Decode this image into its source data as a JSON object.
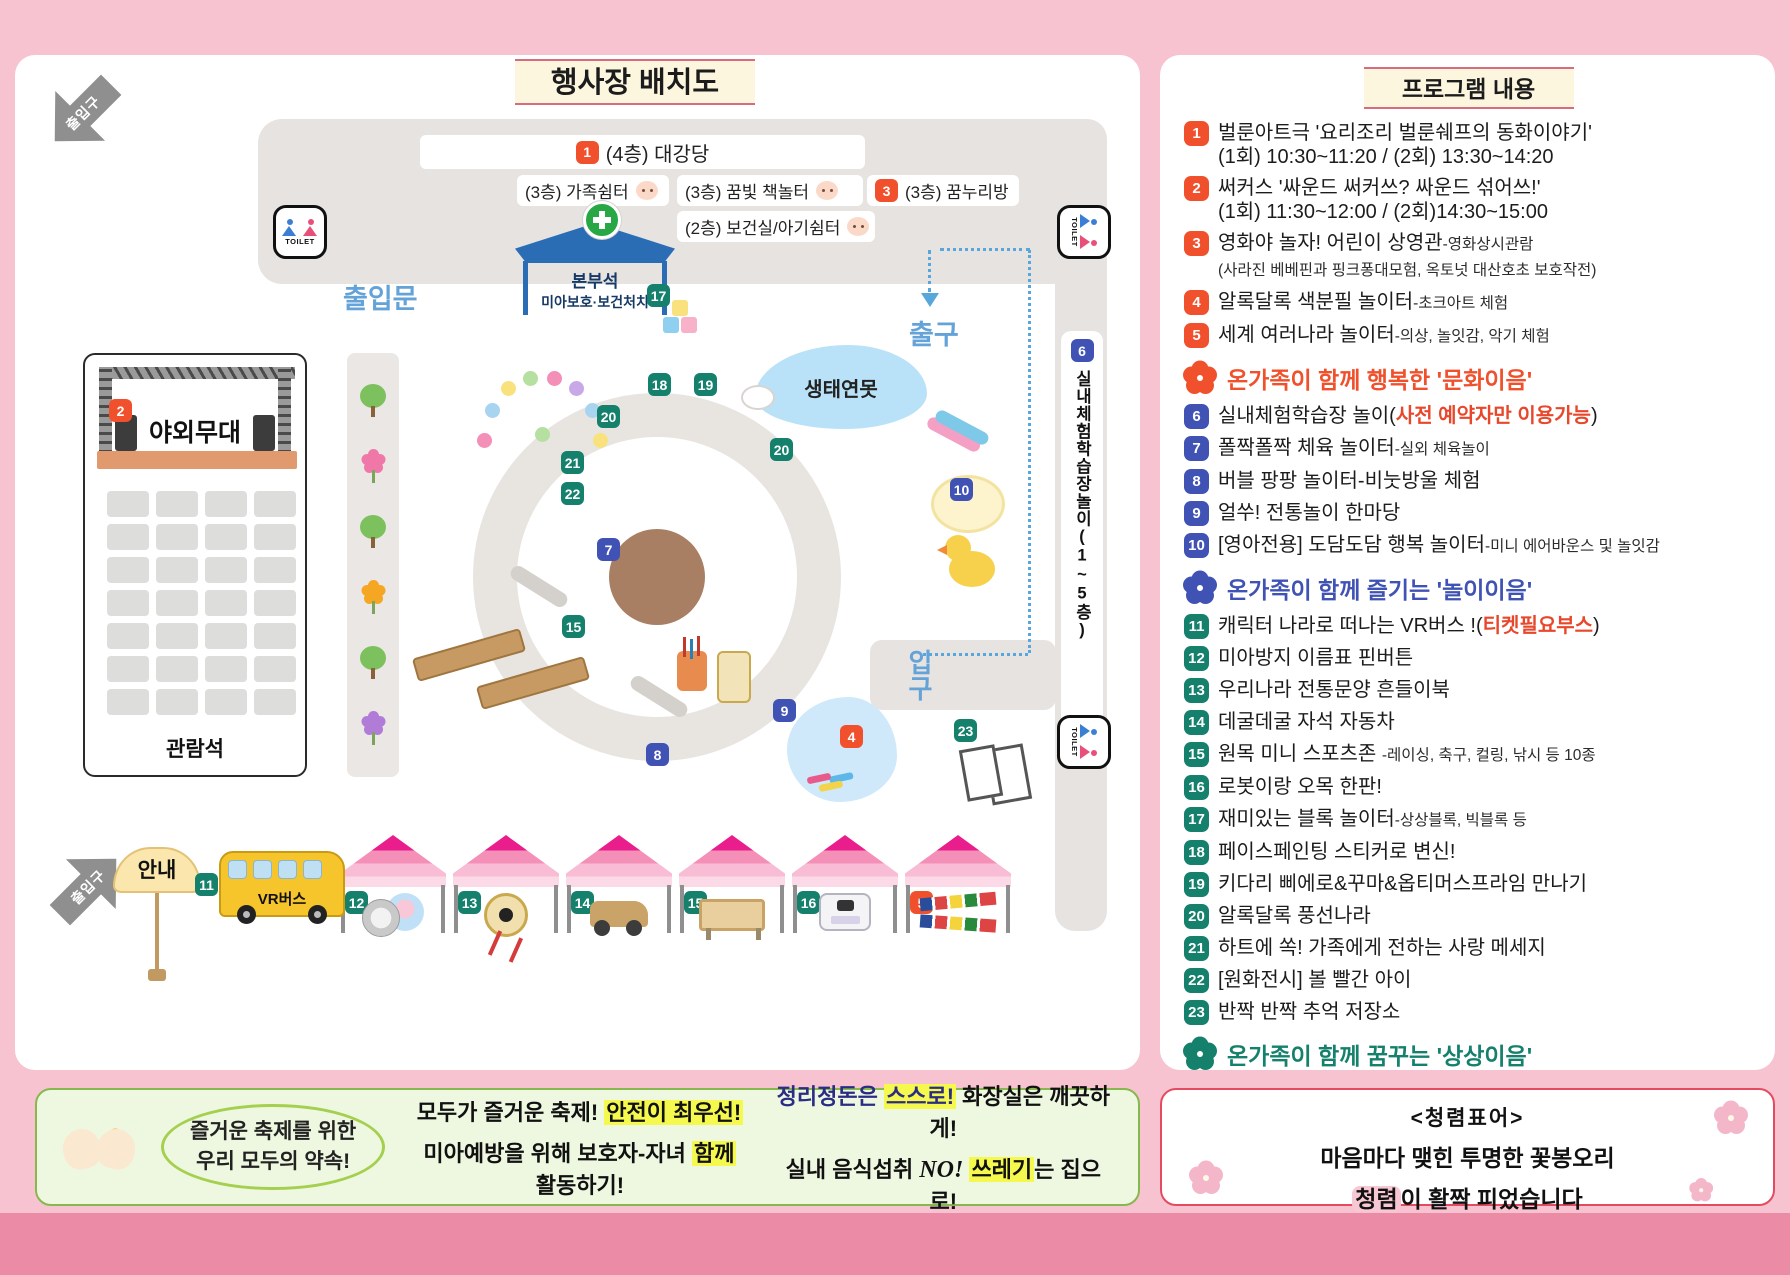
{
  "map": {
    "title": "행사장 배치도",
    "entrance_arrow_label": "출입구",
    "rooms": {
      "hall_num": "1",
      "hall": "(4층) 대강당",
      "family": "(3층) 가족쉼터",
      "book": "(3층) 꿈빛 책놀터",
      "dream_num": "3",
      "dream": "(3층) 꿈누리방",
      "clinic": "(2층) 보건실/아기쉼터"
    },
    "hq_line1": "본부석",
    "hq_line2": "미아보호·보건처치",
    "toilet": "TOILET",
    "door_label": "출입문",
    "exit_label": "출구",
    "enter_label": "입구",
    "pond": "생태연못",
    "stage_num": "2",
    "stage": "야외무대",
    "seats": "관람석",
    "indoor_num": "6",
    "indoor": "실내체험학습장놀이(1~5층)",
    "info": "안내",
    "bus_num": "11",
    "bus": "VR버스",
    "markers": [
      {
        "n": "17",
        "c": "teal",
        "x": 632,
        "y": 229
      },
      {
        "n": "18",
        "c": "teal",
        "x": 633,
        "y": 318
      },
      {
        "n": "19",
        "c": "teal",
        "x": 679,
        "y": 318
      },
      {
        "n": "20",
        "c": "teal",
        "x": 582,
        "y": 350
      },
      {
        "n": "20",
        "c": "teal",
        "x": 755,
        "y": 383
      },
      {
        "n": "21",
        "c": "teal",
        "x": 546,
        "y": 396
      },
      {
        "n": "22",
        "c": "teal",
        "x": 546,
        "y": 427
      },
      {
        "n": "7",
        "c": "blue",
        "x": 582,
        "y": 483
      },
      {
        "n": "15",
        "c": "teal",
        "x": 547,
        "y": 560
      },
      {
        "n": "9",
        "c": "blue",
        "x": 758,
        "y": 644
      },
      {
        "n": "8",
        "c": "blue",
        "x": 631,
        "y": 688
      },
      {
        "n": "10",
        "c": "blue",
        "x": 935,
        "y": 423
      },
      {
        "n": "4",
        "c": "red",
        "x": 825,
        "y": 670
      },
      {
        "n": "23",
        "c": "teal",
        "x": 939,
        "y": 664
      }
    ],
    "tents": [
      {
        "n": "12",
        "c": "teal",
        "deco": "button"
      },
      {
        "n": "13",
        "c": "teal",
        "deco": "drum"
      },
      {
        "n": "14",
        "c": "teal",
        "deco": "car"
      },
      {
        "n": "15",
        "c": "teal",
        "deco": "sand"
      },
      {
        "n": "16",
        "c": "teal",
        "deco": "robot"
      },
      {
        "n": "5",
        "c": "red",
        "deco": "flags"
      }
    ]
  },
  "program": {
    "title": "프로그램 내용",
    "sections": [
      {
        "title": "온가족이 함께 행복한 '문화이음'",
        "color": "#f0512c",
        "items": [
          {
            "n": "1",
            "l1": [
              [
                "m",
                "벌룬아트극 '요리조리 벌룬쉐프의 동화이야기'"
              ]
            ],
            "l2": [
              [
                "m",
                "(1회) 10:30~11:20 / (2회) 13:30~14:20"
              ]
            ]
          },
          {
            "n": "2",
            "l1": [
              [
                "m",
                "써커스 '싸운드 써커쓰? 싸운드 섞어쓰!'"
              ]
            ],
            "l2": [
              [
                "m",
                "(1회) 11:30~12:00 / (2회)14:30~15:00"
              ]
            ]
          },
          {
            "n": "3",
            "l1": [
              [
                "m",
                "영화야 놀자! 어린이 상영관"
              ],
              [
                "s",
                "-영화상시관람"
              ]
            ],
            "l2": [
              [
                "s",
                "(사라진 베베핀과 핑크퐁대모험, 옥토넛 대산호초 보호작전)"
              ]
            ]
          },
          {
            "n": "4",
            "l1": [
              [
                "m",
                "알록달록 색분필 놀이터"
              ],
              [
                "s",
                "-초크아트 체험"
              ]
            ]
          },
          {
            "n": "5",
            "l1": [
              [
                "m",
                "세계 여러나라 놀이터"
              ],
              [
                "s",
                "-의상, 놀잇감, 악기 체험"
              ]
            ]
          }
        ]
      },
      {
        "title": "온가족이 함께 즐기는 '놀이이음'",
        "color": "#4053b5",
        "items": [
          {
            "n": "6",
            "l1": [
              [
                "m",
                "실내체험학습장 놀이("
              ],
              [
                "r",
                "사전 예약자만 이용가능"
              ],
              [
                "m",
                ")"
              ]
            ]
          },
          {
            "n": "7",
            "l1": [
              [
                "m",
                "폴짝폴짝 체육 놀이터"
              ],
              [
                "s",
                "-실외 체육놀이"
              ]
            ]
          },
          {
            "n": "8",
            "l1": [
              [
                "m",
                "버블 팡팡 놀이터-비눗방울 체험"
              ]
            ]
          },
          {
            "n": "9",
            "l1": [
              [
                "m",
                "얼쑤! 전통놀이 한마당"
              ]
            ]
          },
          {
            "n": "10",
            "l1": [
              [
                "m",
                "[영아전용] 도담도담 행복 놀이터"
              ],
              [
                "s",
                "-미니 에어바운스 및 놀잇감"
              ]
            ]
          }
        ]
      },
      {
        "title": "온가족이 함께 꿈꾸는 '상상이음'",
        "color": "#15806c",
        "items": [
          {
            "n": "11",
            "l1": [
              [
                "m",
                "캐릭터 나라로 떠나는 VR버스 !("
              ],
              [
                "r",
                "티켓필요부스"
              ],
              [
                "m",
                ")"
              ]
            ]
          },
          {
            "n": "12",
            "l1": [
              [
                "m",
                "미아방지 이름표 핀버튼"
              ]
            ]
          },
          {
            "n": "13",
            "l1": [
              [
                "m",
                "우리나라 전통문양 흔들이북"
              ]
            ]
          },
          {
            "n": "14",
            "l1": [
              [
                "m",
                "데굴데굴 자석 자동차"
              ]
            ]
          },
          {
            "n": "15",
            "l1": [
              [
                "m",
                "원목 미니 스포츠존 "
              ],
              [
                "s",
                "-레이싱, 축구, 컬링, 낚시 등 10종"
              ]
            ]
          },
          {
            "n": "16",
            "l1": [
              [
                "m",
                "로봇이랑 오목 한판!"
              ]
            ]
          },
          {
            "n": "17",
            "l1": [
              [
                "m",
                "재미있는 블록 놀이터"
              ],
              [
                "s",
                "-상상블록, 빅블록 등"
              ]
            ]
          },
          {
            "n": "18",
            "l1": [
              [
                "m",
                "페이스페인팅 스티커로 변신!"
              ]
            ]
          },
          {
            "n": "19",
            "l1": [
              [
                "m",
                "키다리 삐에로&꾸마&옵티머스프라임 만나기"
              ]
            ]
          },
          {
            "n": "20",
            "l1": [
              [
                "m",
                "알록달록 풍선나라"
              ]
            ]
          },
          {
            "n": "21",
            "l1": [
              [
                "m",
                "하트에 쏙! 가족에게 전하는 사랑 메세지"
              ]
            ]
          },
          {
            "n": "22",
            "l1": [
              [
                "m",
                "[원화전시] 볼 빨간 아이"
              ]
            ]
          },
          {
            "n": "23",
            "l1": [
              [
                "m",
                "반짝 반짝 추억 저장소"
              ]
            ]
          }
        ]
      }
    ]
  },
  "pledge": {
    "circle1": "즐거운 축제를 위한",
    "circle2": "우리 모두의 약속!",
    "colA": [
      [
        [
          "",
          "모두가 즐거운 축제! "
        ],
        [
          "hl",
          "안전이 최우선!"
        ]
      ],
      [
        [
          "",
          "미아예방을 위해 보호자-자녀 "
        ],
        [
          "hl",
          "함께"
        ],
        [
          "",
          " 활동하기!"
        ]
      ]
    ],
    "colB": [
      [
        [
          "navy",
          "정리정돈은 "
        ],
        [
          "navyhl",
          "스스로!"
        ],
        [
          "",
          " 화장실은 깨끗하게!"
        ]
      ],
      [
        [
          "",
          "실내 음식섭취 "
        ],
        [
          "no",
          "NO!"
        ],
        [
          "",
          " "
        ],
        [
          "hl",
          "쓰레기"
        ],
        [
          "",
          "는 집으로!"
        ]
      ]
    ]
  },
  "integrity": {
    "title": "<청렴표어>",
    "line1": "마음마다 맺힌 투명한 꽃봉오리",
    "line2": [
      [
        "phl",
        "청렴"
      ],
      [
        "",
        "이 활짝 피었습니다"
      ]
    ]
  }
}
